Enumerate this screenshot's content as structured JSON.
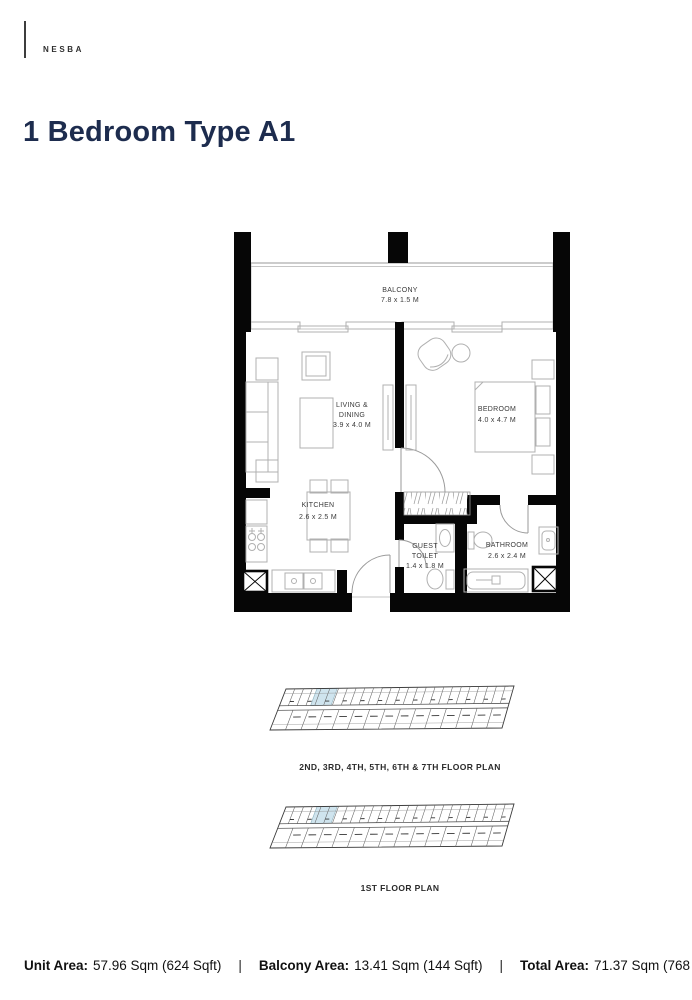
{
  "brand": {
    "name": "NESBA"
  },
  "page": {
    "title": "1 Bedroom Type A1"
  },
  "unit_plan": {
    "balcony": {
      "name": "BALCONY",
      "dims": "7.8 x 1.5 M"
    },
    "living_dining": {
      "name_line1": "LIVING &",
      "name_line2": "DINING",
      "dims": "3.9 x 4.0 M"
    },
    "bedroom": {
      "name": "BEDROOM",
      "dims": "4.0 x 4.7 M"
    },
    "kitchen": {
      "name": "KITCHEN",
      "dims": "2.6 x 2.5 M"
    },
    "guest_toilet": {
      "name_line1": "GUEST",
      "name_line2": "TOILET",
      "dims": "1.4 x 1.8 M"
    },
    "bathroom": {
      "name": "BATHROOM",
      "dims": "2.6 x 2.4 M"
    }
  },
  "building_plans": {
    "upper": {
      "caption": "2ND, 3RD, 4TH, 5TH, 6TH & 7TH FLOOR PLAN"
    },
    "first": {
      "caption": "1ST FLOOR PLAN"
    }
  },
  "footer": {
    "separator": "|",
    "items": [
      {
        "label": "Unit Area:",
        "value": "57.96 Sqm (624 Sqft)"
      },
      {
        "label": "Balcony Area:",
        "value": "13.41 Sqm (144 Sqft)"
      },
      {
        "label": "Total Area:",
        "value": "71.37 Sqm (768 Sqft)"
      }
    ]
  },
  "colors": {
    "title_navy": "#1d2c4e",
    "wall_black": "#060606",
    "highlight_blue": "#cfe4ee"
  }
}
